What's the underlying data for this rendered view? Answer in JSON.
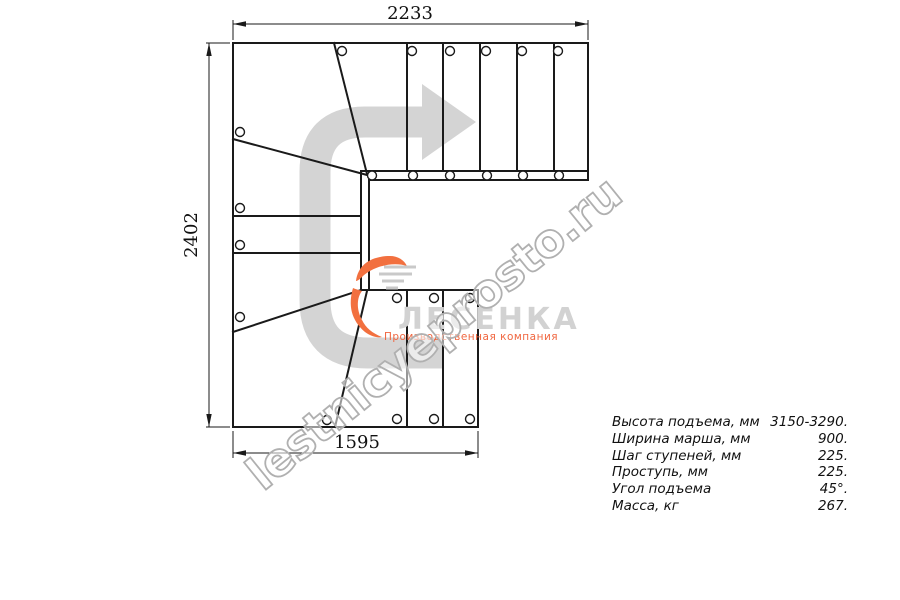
{
  "drawing": {
    "dimensions": {
      "top_width_mm": "2233",
      "left_height_mm": "2402",
      "bottom_width_mm": "1595"
    }
  },
  "watermark": {
    "text": "lestnicyeprosto.ru"
  },
  "logo": {
    "name": "ЛЕСЕНКА",
    "tagline": "Производственная компания",
    "accent_color": "#f2703f",
    "text_color": "#d2d2d2"
  },
  "colors": {
    "line": "#1a1a1a",
    "arrow_gray": "#d4d4d4",
    "watermark_gray": "#b0b0b0"
  },
  "specs": {
    "rows": [
      {
        "label": "Высота подъема, мм",
        "value": "3150-3290."
      },
      {
        "label": "Ширина марша, мм",
        "value": "900."
      },
      {
        "label": "Шаг ступеней, мм",
        "value": "225."
      },
      {
        "label": "Проступь, мм",
        "value": "225."
      },
      {
        "label": "Угол подъема",
        "value": "45°."
      },
      {
        "label": "Масса, кг",
        "value": "267."
      }
    ]
  }
}
